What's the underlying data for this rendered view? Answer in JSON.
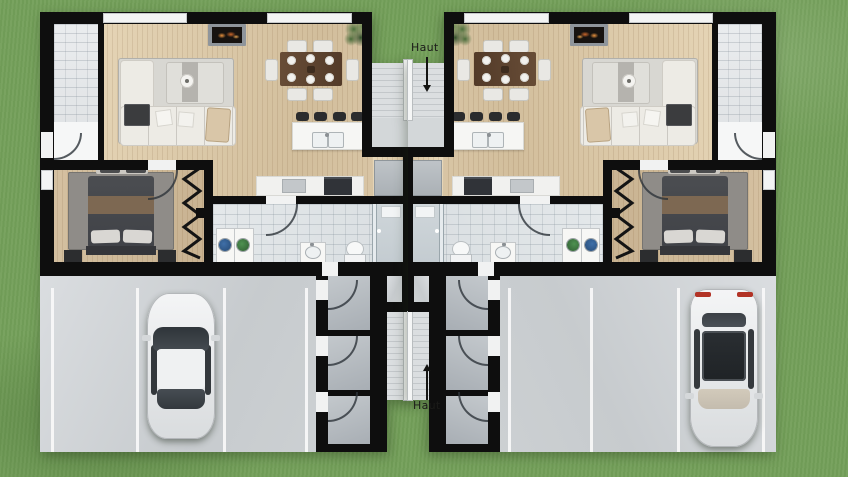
{
  "labels": {
    "stairs_up_top": "Haut",
    "stairs_up_bottom": "Haut"
  },
  "palette": {
    "grass": "#74a05a",
    "wall": "#0e0e0e",
    "wood_floor": "#dcc9a9",
    "terrace_tile": "#e9ebed",
    "bathroom_tile": "#e0e4e7",
    "concrete": "#cdd1d3",
    "stair_tread": "#d8dbde",
    "dining_table": "#5c4330",
    "bed_duvet": "#494b4f",
    "bed_throw": "#7d6852",
    "sofa": "#edebe5",
    "car_body": "#eef0f1",
    "car_glass": "#3c4146",
    "taillight": "#b23326",
    "fireplace_flame": "#d97c34",
    "plant": "#4c713c",
    "label_text": "#1b1b19"
  }
}
